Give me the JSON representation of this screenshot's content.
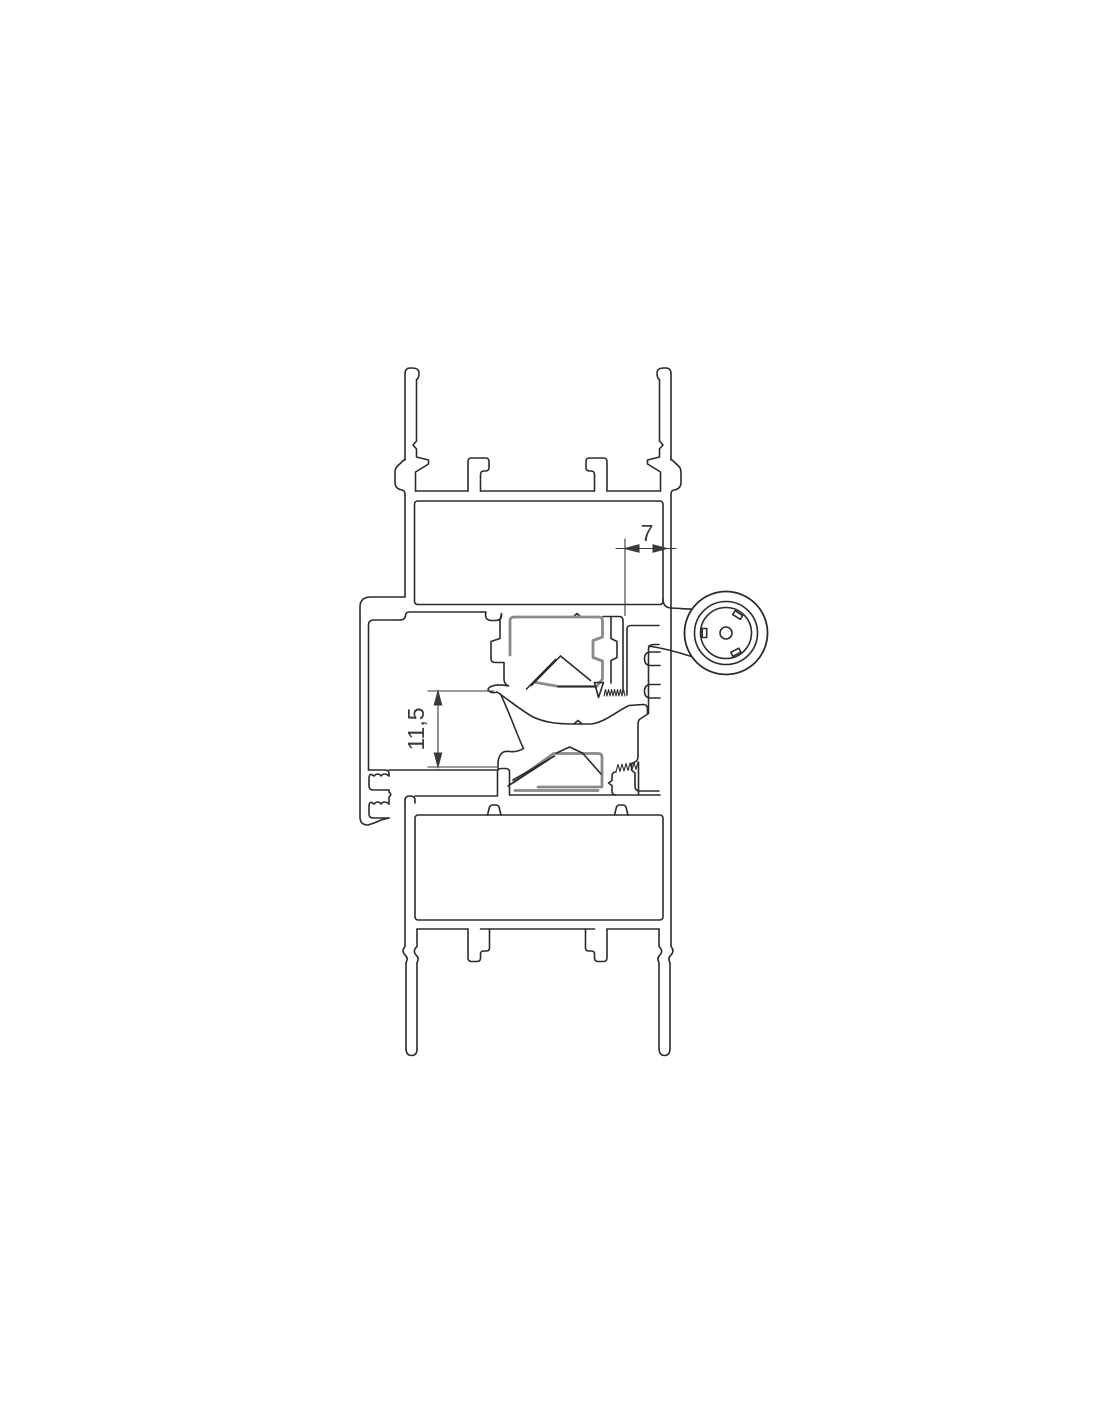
{
  "drawing": {
    "title": "aluminium-profile-cross-section",
    "colors": {
      "background": "#ffffff",
      "outline": "#2b2b2b",
      "gasket": "#8a8a8a",
      "dimension": "#3a3a3a"
    },
    "dimensions": [
      {
        "id": "gap-width",
        "value": "7"
      },
      {
        "id": "clearance-height",
        "value": "11,5"
      }
    ]
  }
}
